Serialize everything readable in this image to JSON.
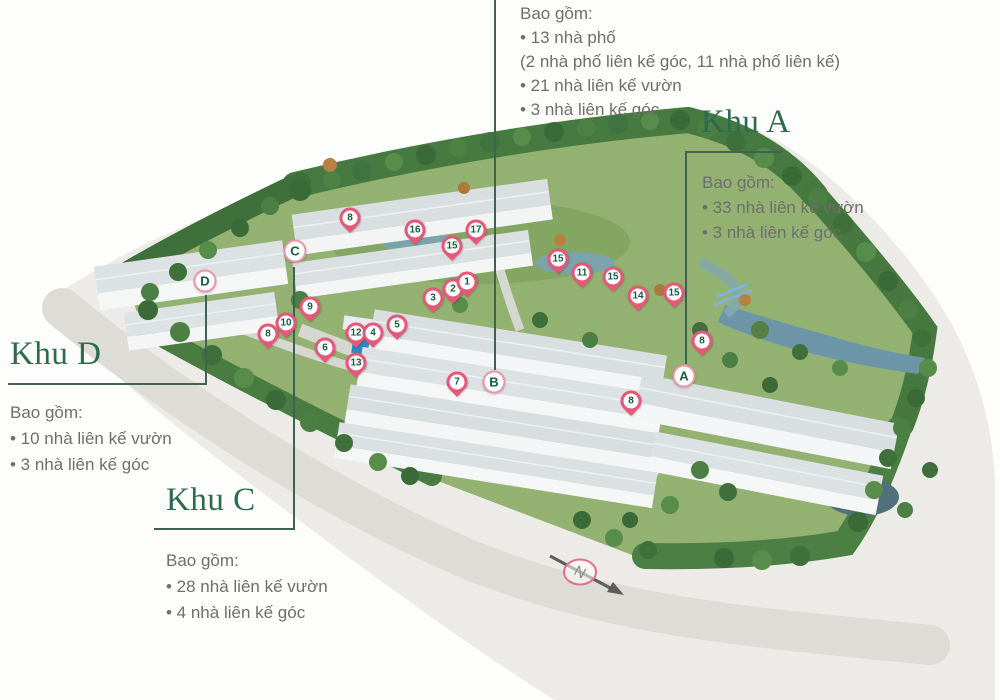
{
  "colors": {
    "heading_green": "#2d6a50",
    "body_gray": "#6e6e6e",
    "callout_line": "#3f6252",
    "pin_pink": "#e65778",
    "pin_ring_pink": "#ec94a9",
    "pin_text_green": "#1a5a41",
    "lawn_green": "#93b171",
    "water_blue": "#6d95a8",
    "pool_blue": "#2f86c6"
  },
  "zones": {
    "top": {
      "intro": "Bao gồm:",
      "items": [
        "• 13 nhà phố",
        "(2 nhà phố liên kế góc, 11 nhà phố liên kế)",
        "• 21 nhà liên kế vườn",
        "• 3 nhà liên kế góc"
      ]
    },
    "khu_a": {
      "title": "Khu A",
      "intro": "Bao gồm:",
      "items": [
        "• 33 nhà liên kế vườn",
        "• 3 nhà liên kế góc"
      ]
    },
    "khu_d": {
      "title": "Khu D",
      "intro": "Bao gồm:",
      "items": [
        "• 10 nhà liên kế vườn",
        "• 3 nhà liên kế góc"
      ]
    },
    "khu_c": {
      "title": "Khu C",
      "intro": "Bao gồm:",
      "items": [
        "• 28 nhà liên kế vườn",
        "• 4 nhà liên kế góc"
      ]
    }
  },
  "map": {
    "compass_label": "N",
    "pins": [
      {
        "label": "8",
        "type": "marker",
        "x": 350,
        "y": 218
      },
      {
        "label": "16",
        "type": "marker",
        "x": 415,
        "y": 230
      },
      {
        "label": "17",
        "type": "marker",
        "x": 476,
        "y": 230
      },
      {
        "label": "15",
        "type": "marker",
        "x": 452,
        "y": 246
      },
      {
        "label": "15",
        "type": "marker",
        "x": 558,
        "y": 259
      },
      {
        "label": "11",
        "type": "marker",
        "x": 582,
        "y": 273
      },
      {
        "label": "15",
        "type": "marker",
        "x": 613,
        "y": 277
      },
      {
        "label": "14",
        "type": "marker",
        "x": 638,
        "y": 296
      },
      {
        "label": "15",
        "type": "marker",
        "x": 674,
        "y": 293
      },
      {
        "label": "8",
        "type": "marker",
        "x": 702,
        "y": 341
      },
      {
        "label": "C",
        "type": "circle",
        "x": 295,
        "y": 251
      },
      {
        "label": "D",
        "type": "circle",
        "x": 205,
        "y": 281
      },
      {
        "label": "9",
        "type": "marker",
        "x": 310,
        "y": 307
      },
      {
        "label": "10",
        "type": "marker",
        "x": 286,
        "y": 323
      },
      {
        "label": "8",
        "type": "marker",
        "x": 268,
        "y": 334
      },
      {
        "label": "12",
        "type": "marker",
        "x": 356,
        "y": 333
      },
      {
        "label": "4",
        "type": "marker",
        "x": 373,
        "y": 333
      },
      {
        "label": "5",
        "type": "marker",
        "x": 397,
        "y": 325
      },
      {
        "label": "3",
        "type": "marker",
        "x": 433,
        "y": 298
      },
      {
        "label": "2",
        "type": "marker",
        "x": 453,
        "y": 289
      },
      {
        "label": "1",
        "type": "marker",
        "x": 467,
        "y": 282
      },
      {
        "label": "6",
        "type": "marker",
        "x": 325,
        "y": 348
      },
      {
        "label": "13",
        "type": "marker",
        "x": 356,
        "y": 363
      },
      {
        "label": "7",
        "type": "marker",
        "x": 457,
        "y": 382
      },
      {
        "label": "B",
        "type": "circle",
        "x": 494,
        "y": 382
      },
      {
        "label": "8",
        "type": "marker",
        "x": 631,
        "y": 401
      },
      {
        "label": "A",
        "type": "circle",
        "x": 684,
        "y": 376
      }
    ]
  }
}
